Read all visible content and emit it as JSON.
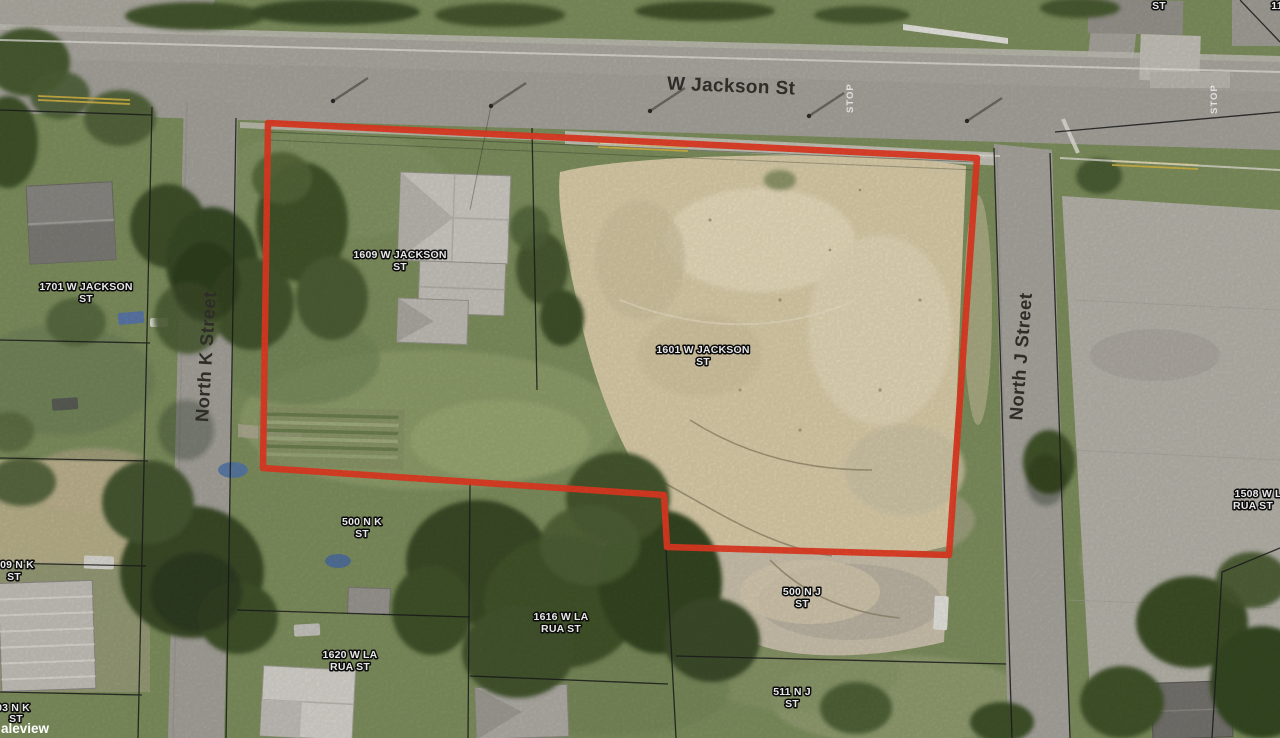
{
  "title": "Aerial parcel map",
  "colors": {
    "selection_red": "#e83b23",
    "parcel_line": "#1c1c1c",
    "label_fill": "#ffffff",
    "label_halo": "#0d0d0d",
    "street_label": "#34322d",
    "asphalt": "#a8a59e",
    "concrete": "#b8b5ac",
    "grass": "#7f915f",
    "sand": "#dccfab",
    "center_line_yellow": "#d9b945"
  },
  "streets": {
    "w_jackson": "W Jackson St",
    "north_k": "North K Street",
    "north_j": "North J Street"
  },
  "road_markings": {
    "stop": "STOP"
  },
  "parcel_labels": [
    {
      "id": "1701-w-jackson-st",
      "line1": "1701 W JACKSON",
      "line2": "ST"
    },
    {
      "id": "1609-w-jackson-st",
      "line1": "1609 W JACKSON",
      "line2": "ST"
    },
    {
      "id": "1601-w-jackson-st",
      "line1": "1601 W JACKSON",
      "line2": "ST"
    },
    {
      "id": "500-n-k-st",
      "line1": "500 N K",
      "line2": "ST"
    },
    {
      "id": "509-n-k-st",
      "line1": "509 N K",
      "line2": "ST"
    },
    {
      "id": "503-n-k-st",
      "line1": "503 N K",
      "line2": "ST"
    },
    {
      "id": "1616-w-la-rua-st",
      "line1": "1616 W LA",
      "line2": "RUA ST"
    },
    {
      "id": "1620-w-la-rua-st",
      "line1": "1620 W LA",
      "line2": "RUA ST"
    },
    {
      "id": "500-n-j-st",
      "line1": "500 N J",
      "line2": "ST"
    },
    {
      "id": "511-n-j-st",
      "line1": "511 N J",
      "line2": "ST"
    },
    {
      "id": "1508-w-la-rua-st",
      "line1": "1508 W LA",
      "line2": "RUA ST"
    },
    {
      "id": "partial-top-st",
      "line1": "ST",
      "line2": ""
    },
    {
      "id": "partial-top-right",
      "line1": "11",
      "line2": ""
    }
  ],
  "watermark": "aleview"
}
